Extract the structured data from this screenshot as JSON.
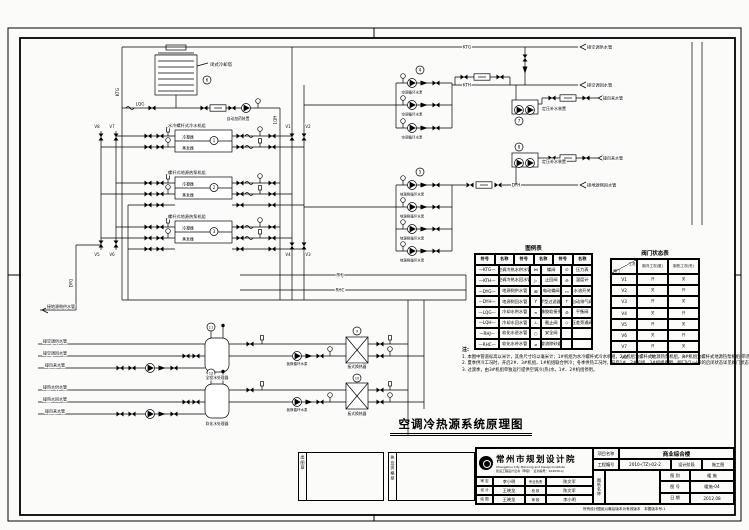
{
  "title": {
    "main": "空调冷热源系统原理图"
  },
  "labels": {
    "ktg": "KTG",
    "kth": "KTH",
    "dyg": "DYG",
    "dyh": "DYH",
    "lqg": "LQG",
    "lqh": "LQH",
    "rhj": "RHJ",
    "rhc": "RHC",
    "v1": "V1",
    "v2": "V2",
    "v3": "V3",
    "v4": "V4",
    "v5": "V5",
    "v6": "V6",
    "v7": "V7",
    "v8": "V8",
    "cooling_tower": "闭式冷却塔",
    "dosing": "自动加药装置",
    "chiller1": "水冷螺杆式冷水机组",
    "chiller2": "螺杆式地源热泵机组",
    "chiller3": "螺杆式地源热泵机组",
    "condenser": "冷凝器",
    "evaporator": "蒸发器",
    "pump_a": "空调循环水泵",
    "pump_b": "地源侧循环水泵",
    "press_unit": "定压补水装置",
    "hx": "板式换热器",
    "hx_pump": "板换循环水泵",
    "tank_a": "全程水处理器",
    "tank_b": "软化水处理器",
    "arrow_ktg": "接空调供水管",
    "arrow_kth": "接空调回水管",
    "arrow_tap": "接自来水管",
    "arrow_dyh": "接地源侧回水管",
    "arrow_dyg": "接地源侧供水管",
    "bl1": "接空调供水管",
    "bl2": "接空调回水管",
    "bl3": "接自来水管",
    "bl4": "接热水供水管",
    "bl5": "接热水回水管",
    "bl6": "接自来水管"
  },
  "tags": {
    "t1": "1",
    "t2": "2",
    "t3": "3",
    "t4": "4",
    "t5": "5",
    "t6": "6",
    "t7": "7",
    "t8": "8",
    "t9": "9",
    "t10": "10",
    "t11": "11",
    "t12": "12"
  },
  "legend": {
    "title": "图例表",
    "header": [
      "符号",
      "名称",
      "符号",
      "名称",
      "符号",
      "名称"
    ],
    "rows": [
      [
        "—KTG—",
        "空调冷热水供水管",
        "⋈",
        "蝶阀",
        "⊙",
        "压力表"
      ],
      [
        "—KTH—",
        "空调冷热水回水管",
        "▷",
        "止回阀",
        "⊖",
        "温度计"
      ],
      [
        "—DYG—",
        "地源侧供水管",
        "⊠",
        "电动蝶阀",
        "▭",
        "水流开关"
      ],
      [
        "—DYH—",
        "地源侧回水管",
        "Y",
        "Y型过滤器",
        "↑",
        "自动排气阀"
      ],
      [
        "—LQG—",
        "冷却水供水管",
        "≈",
        "橡胶软接头",
        "⊘",
        "平衡阀"
      ],
      [
        "—LQH—",
        "冷却水回水管",
        "⊥",
        "截止阀",
        "◇",
        "压差旁通阀"
      ],
      [
        "—RHJ—",
        "软化水进水管",
        "○",
        "安全阀",
        "",
        ""
      ],
      [
        "—RHC—",
        "软化水补水管",
        "⌀",
        "旋流除砂器",
        "",
        ""
      ]
    ]
  },
  "valve_table": {
    "title": "阀门状态表",
    "corner_top": "工况",
    "corner_bottom": "阀门",
    "col1": "制冷工况(夏)",
    "col2": "制热工况(冬)",
    "rows": [
      [
        "V1",
        "开",
        "关"
      ],
      [
        "V2",
        "关",
        "开"
      ],
      [
        "V3",
        "开",
        "关"
      ],
      [
        "V4",
        "关",
        "开"
      ],
      [
        "V5",
        "开",
        "关"
      ],
      [
        "V6",
        "关",
        "开"
      ],
      [
        "V7",
        "开",
        "关"
      ],
      [
        "V8",
        "关",
        "开"
      ]
    ]
  },
  "notes": {
    "label": "注:",
    "items": [
      "1. 本图中管道标高以米计，其余尺寸均以毫米计；1#机组为水冷螺杆式冷水机组，2#机组为螺杆式地源热泵机组，3#机组为螺杆式地源热泵机组(带热回收)。",
      "2. 夏季供冷工况时，开启2#、3#机组，1#机组联合供冷；冬季供热工况时，开启1#、2#机组，3#机组备用，阀门V1～V8的启闭状态详见阀门状态表。",
      "3. 过渡季，由3#机组单独运行提供空调冷(热)水，1#、2#机组停用。"
    ]
  },
  "stamps": {
    "box1": "出图章",
    "box2": "执业资格章"
  },
  "titleblock": {
    "institute": "常州市规划设计院",
    "institute_en": "Changzhou City Planning and Design Institute",
    "cert": "建设工程设计证书（甲级）　证书编号：102030-sj",
    "people": [
      [
        "审 定",
        "李小明",
        "专业负责",
        "陈文军"
      ],
      [
        "设 计",
        "王晓龙",
        "校 核",
        "陈文军"
      ],
      [
        "绘 图",
        "王晓龙",
        "审 核",
        "李小明"
      ]
    ],
    "project_label": "项目名称",
    "project": "商业综合楼",
    "no_label": "工程编号",
    "no": "2010-(TZ)-02-2",
    "stage_label": "设计阶段",
    "stage": "施工图",
    "sheetname_label": "图纸名称",
    "rows": [
      [
        "图 别",
        "暖 施"
      ],
      [
        "图 号",
        "暖施-04"
      ],
      [
        "日 期",
        "2012.08"
      ]
    ],
    "footnote": "所有设计图纸以最后版本为有效版本　本图版本号:1"
  }
}
